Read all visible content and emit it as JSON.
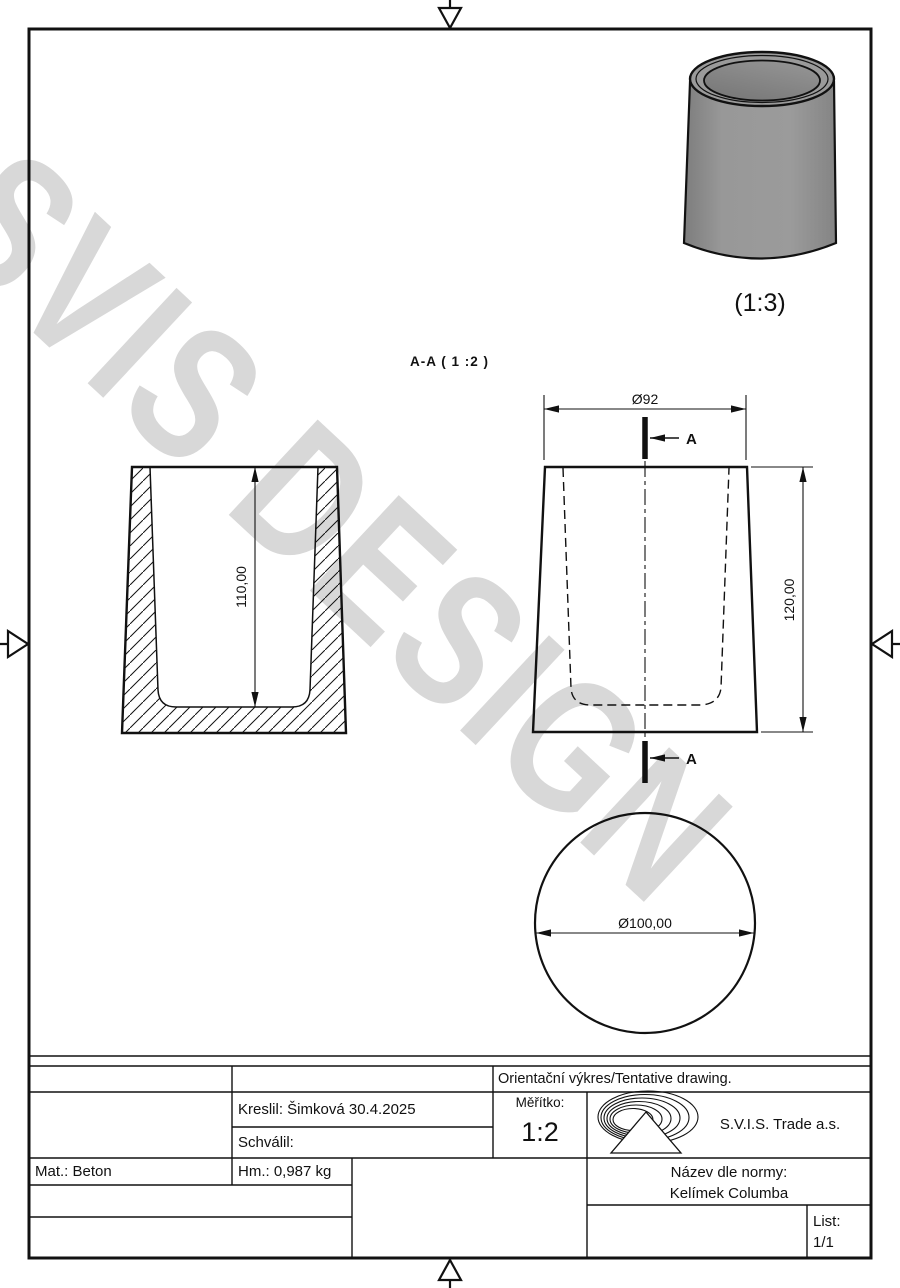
{
  "watermark": {
    "text": "SVIS DESIGN"
  },
  "labels": {
    "section_view": "A-A ( 1 :2 )",
    "iso_scale": "(1:3)",
    "section_arrow_top": "A",
    "section_arrow_bottom": "A"
  },
  "dims": {
    "front_top_diameter": "Ø92",
    "front_height": "120,00",
    "section_inner_depth": "110,00",
    "bottom_diameter": "Ø100,00"
  },
  "title_block": {
    "tentative": "Orientační výkres/Tentative drawing.",
    "drawn": "Kreslil: Šimková 30.4.2025",
    "approved": "Schválil:",
    "scale_label": "Měřítko:",
    "scale_value": "1:2",
    "company": "S.V.I.S. Trade a.s.",
    "material": "Mat.: Beton",
    "mass": "Hm.: 0,987 kg",
    "name_label": "Název dle normy:",
    "name_value": "Kelímek Columba",
    "sheet_label": "List:",
    "sheet_value": "1/1"
  },
  "colors": {
    "line": "#111111",
    "watermark": "#d8d8d8",
    "cup_body": "#959595",
    "cup_inner": "#7f7f7f"
  }
}
